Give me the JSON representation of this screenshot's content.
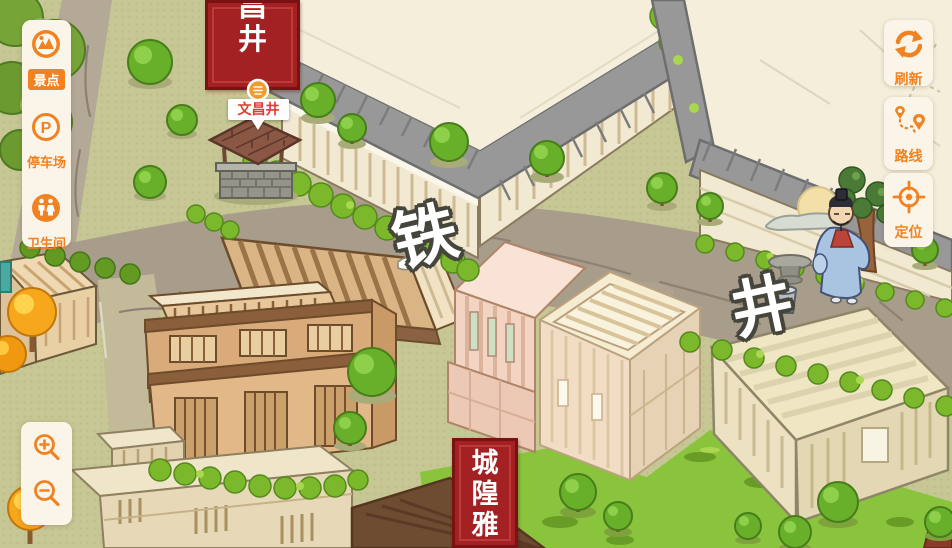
{
  "sidebar": {
    "items": [
      {
        "label": "景点",
        "icon": "scenic-spot-icon",
        "active": true
      },
      {
        "label": "停车场",
        "icon": "parking-icon",
        "icon_letter": "P",
        "active": false
      },
      {
        "label": "卫生间",
        "icon": "restroom-icon",
        "active": false
      }
    ]
  },
  "map_controls": {
    "refresh": "刷新",
    "route": "路线",
    "locate": "定位"
  },
  "map": {
    "street_label_1": "铁",
    "street_label_2": "井",
    "top_banner_text": "文昌井",
    "bottom_banner_text": "城隍雅",
    "poi_label": "文昌井"
  },
  "colors": {
    "accent_orange": "#F08222",
    "panel_cream": "#FBF4E9",
    "banner_red": "#A32023",
    "poi_text_red": "#E23B30",
    "grass_olive": "#C6C794",
    "road_gray": "#A89C8B",
    "hedge_green": "#7CB82B",
    "roof_gray": "#989898"
  }
}
